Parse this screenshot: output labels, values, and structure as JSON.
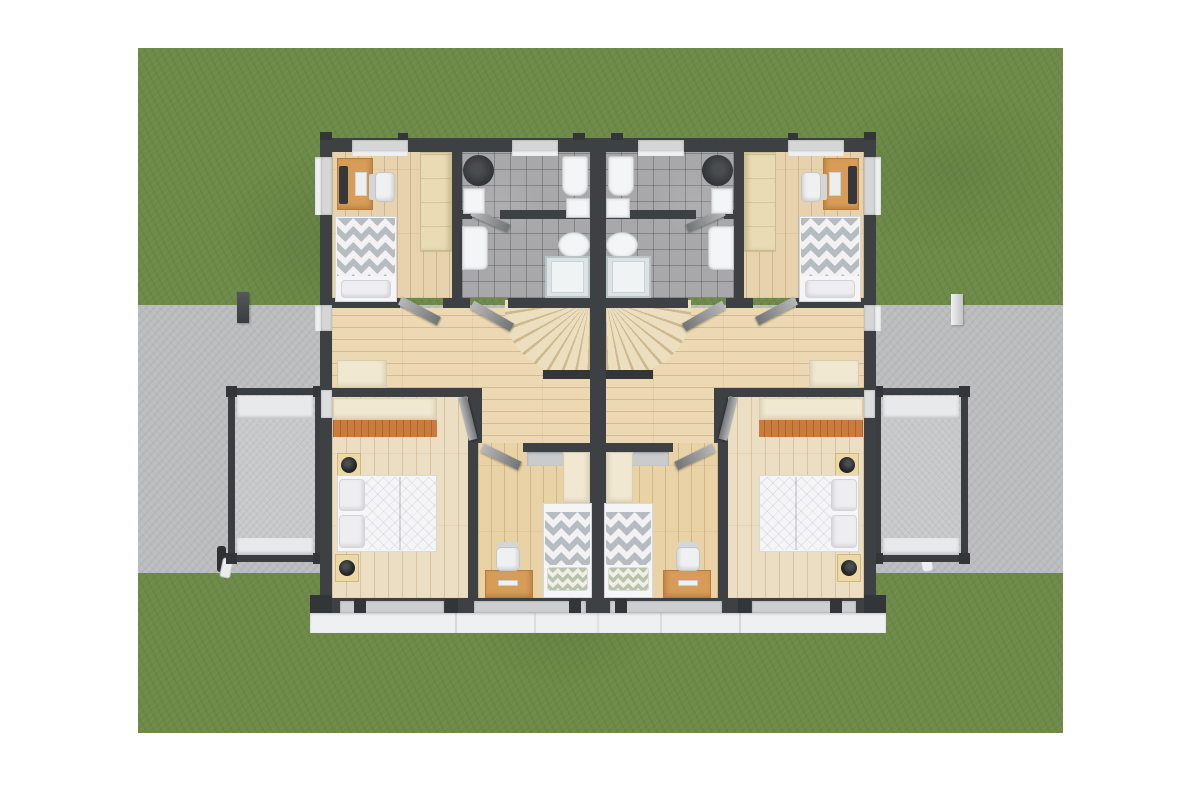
{
  "scene": {
    "type": "3d-architectural-floor-plan-render",
    "view": "top-down",
    "subject": "upper floor of a mirrored duplex (semi-detached) house on a lawn with a paved drive strip",
    "units": [
      {
        "id": "left-unit",
        "mirrored": false
      },
      {
        "id": "right-unit",
        "mirrored": true
      }
    ],
    "rooms_per_unit": [
      "small-bedroom-top (single bed with chevron duvet, desk with monitor, office chair, tall light-wood wardrobe)",
      "bathroom (gray tile, washing machine, two washbasins, two toilets, glass shower)",
      "hallway-landing (winder staircase against party wall, sideboard)",
      "master-bedroom (double bed with quilted white duvet, two nightstands with black lamps, dresser with orange drawer fronts, balcony access)",
      "middle-bedroom (single bed with chevron duvet and sage pillow, desk, office chair, wardrobe)",
      "balcony (concrete floor, dark railing frame, white ledges)"
    ],
    "exterior_features": [
      "lawn",
      "paved-drive-strip",
      "left-dark-post",
      "right-white-post",
      "left-downpipe",
      "right-downpipe",
      "window-sill-band-south",
      "windows-in-dark-walls"
    ]
  },
  "palette": {
    "page_background": "#ffffff",
    "grass": "#6d8a48",
    "road": "#bbbcbe",
    "wall": "#3e4144",
    "wall_dark": "#333639",
    "wood_bedroom": "#e6d3ad",
    "wood_hallway": "#ecd9b3",
    "wood_master": "#ecdec2",
    "wood_middle": "#e9d2a6",
    "tile_bath": "#a8a8aa",
    "stair_tread": "#ecdfc0",
    "stair_shadow": "#cdb98e",
    "balcony_concrete": "#c6c8ca",
    "window_recess": "#d5d6d8",
    "sill_white": "#eef0f1",
    "door_leaf_light": "#b7b8ba",
    "door_leaf_dark": "#737476",
    "duvet_chevron_gray": "#b6bcbf",
    "duvet_white": "#f5f5f7",
    "pillow_sage": "#b9c2ad",
    "wardrobe_cream": "#f0e8d1",
    "wardrobe_light_wood": "#e9dcb4",
    "desk_wood": "#d79c57",
    "dresser_orange": "#c97c3d",
    "fixture_white": "#f4f5f7",
    "appliance_black": "#333639"
  }
}
